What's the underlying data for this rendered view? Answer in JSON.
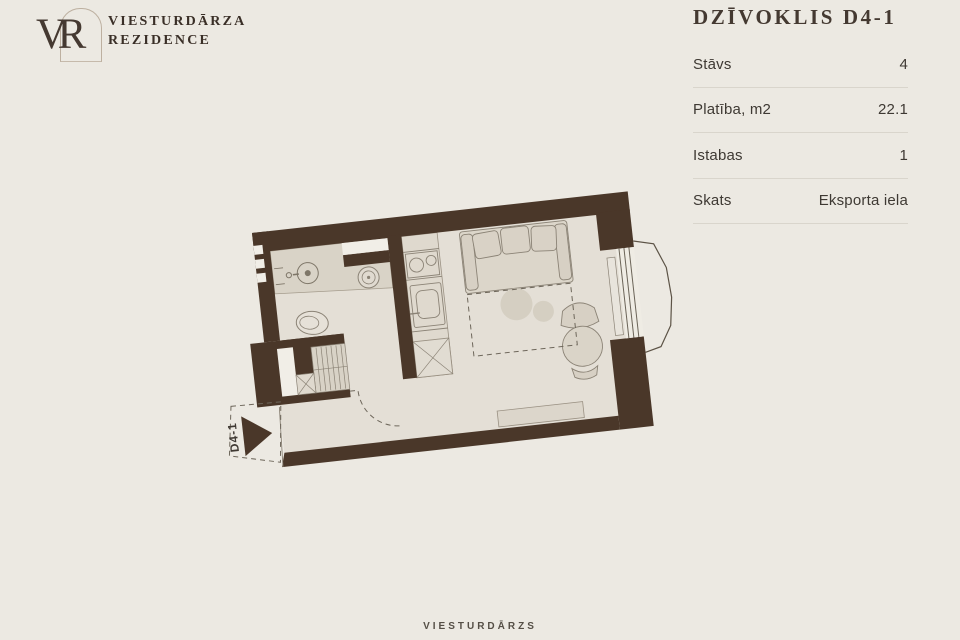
{
  "header": {
    "logo": {
      "monogram": "VR",
      "line1": "VIESTURDĀRZA",
      "line2": "REZIDENCE"
    },
    "title": "DZĪVOKLIS D4-1"
  },
  "details": {
    "rows": [
      {
        "label": "Stāvs",
        "value": "4"
      },
      {
        "label": "Platība, m2",
        "value": "22.1"
      },
      {
        "label": "Istabas",
        "value": "1"
      },
      {
        "label": "Skats",
        "value": "Eksporta iela"
      }
    ]
  },
  "floorplan": {
    "unit_label": "D4-1",
    "colors": {
      "wall": "#4A3729",
      "floor": "#E4DFD6",
      "counter": "#D9D3C7",
      "furniture": "#D8D2C5",
      "outline": "#8B8376",
      "dash": "#6E675B",
      "inset": "#F1EEE7"
    }
  },
  "footer": {
    "text": "VIESTURDĀRZS"
  }
}
